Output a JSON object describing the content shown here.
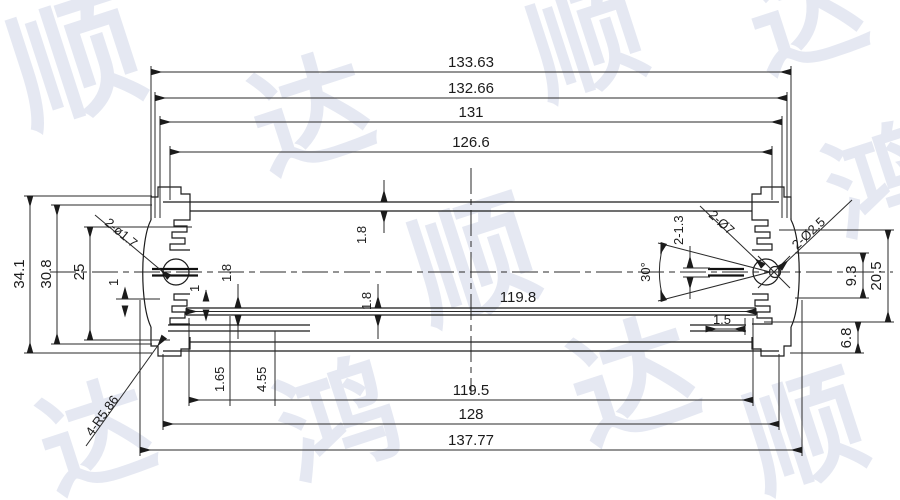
{
  "drawing": {
    "type": "cad-technical-drawing",
    "subject": "aluminum-extrusion-enclosure-profile-cross-section",
    "colors": {
      "line": "#1b1b1b",
      "background": "#ffffff",
      "watermark": "#ccd3e6"
    },
    "watermark": {
      "chars": [
        "顺",
        "达",
        "鸿"
      ]
    },
    "dims": {
      "top": [
        "133.63",
        "132.66",
        "131",
        "126.6"
      ],
      "bottom": [
        "119.5",
        "128",
        "137.77"
      ],
      "left": [
        "34.1",
        "30.8",
        "25"
      ],
      "right": [
        "20.5",
        "9.3",
        "6.8"
      ],
      "inner": {
        "rail_width": "119.8",
        "lip": "1.5"
      },
      "small": {
        "one_a": "1",
        "one_b": "1",
        "wall_top": "1.8",
        "rail_a": "1.8",
        "rail_b": "1.8",
        "slot_a": "1.65",
        "slot_b": "4.55",
        "right_slot": "2-1.3"
      },
      "leaders": {
        "left_hole": "2-ø1.7",
        "corner_radius": "4-R5.86",
        "right_hole_large": "2-Ø7",
        "right_hole_small": "2-Ø2.5"
      },
      "angle": "30°"
    }
  }
}
